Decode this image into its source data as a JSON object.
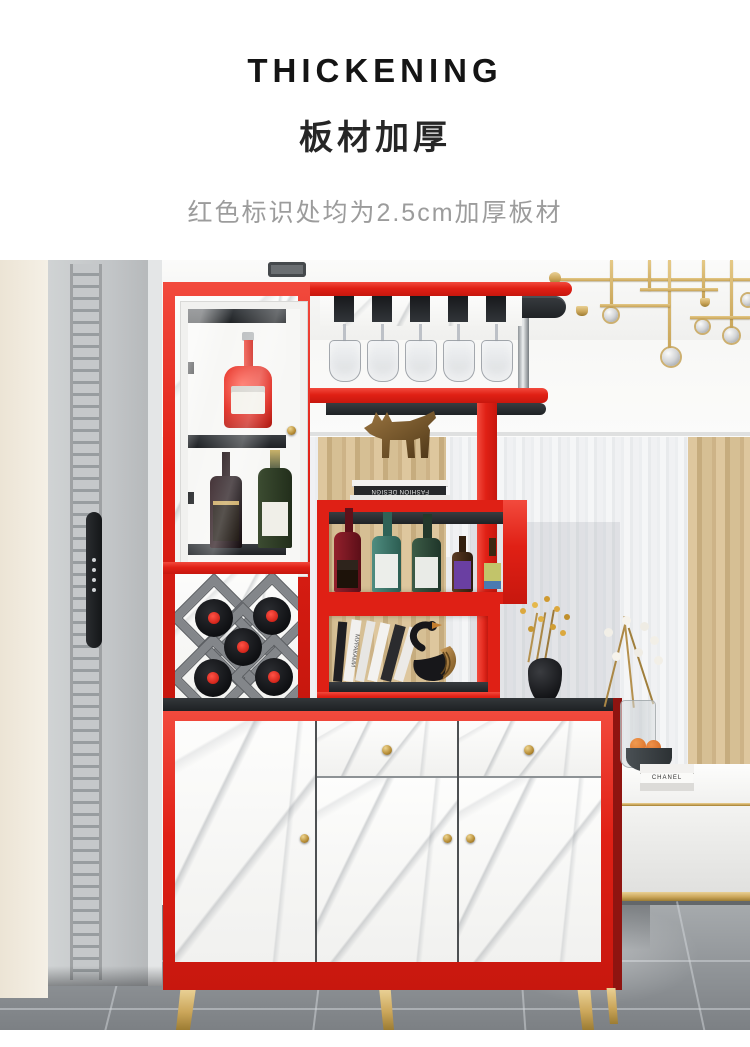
{
  "header": {
    "title_en": "THICKENING",
    "title_zh": "板材加厚",
    "subtitle": "红色标识处均为2.5cm加厚板材"
  },
  "scene": {
    "decor_text": {
      "dog_book_spine": "FASHION DESIGN",
      "swan_book_spine": "МУРАКАМИ",
      "bench_book_spine": "CHANEL"
    },
    "colors": {
      "accent_red": "#e02015",
      "gold": "#c9a558",
      "counter_dark": "#2e3134",
      "curtain_beige": "#d5bd92",
      "floor_gray": "#8d9194",
      "marble_white": "#fbfbfa"
    }
  }
}
